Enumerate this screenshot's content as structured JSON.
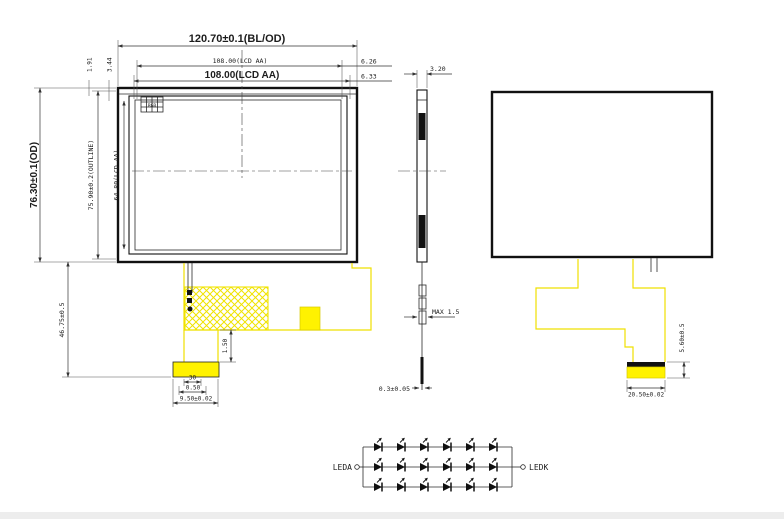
{
  "meta": {
    "title": "TFT LCD module outline drawing"
  },
  "front_view": {
    "dim_od_width": "120.70±0.1(BL/OD)",
    "dim_aa_width_small": "108.00(LCD AA)",
    "dim_aa_width": "108.00(LCD AA)",
    "dim_right_top": "6.26",
    "dim_right_bottom": "6.33",
    "dim_od_height": "76.30±0.1(OD)",
    "dim_outline_height": "75.90±0.2(OUTLINE)",
    "dim_aa_height": "64.80(LCD AA)",
    "dim_corner_a": "1.91",
    "dim_corner_b": "3.44",
    "dim_fpc_drop": "46.75±0.5",
    "dim_neck": "1.50",
    "dim_pins": "30",
    "dim_pitch": "0.50",
    "dim_tail_width": "9.50±0.02",
    "corner_detail_label": "RGB"
  },
  "side_view": {
    "dim_thickness": "3.20",
    "dim_connector_max": "MAX 1.5",
    "dim_film": "0.3±0.05"
  },
  "back_view": {
    "dim_stiffener_height": "5.60±0.5",
    "dim_stiffener_width": "20.50±0.02"
  },
  "led_circuit": {
    "anode_label": "LEDA",
    "cathode_label": "LEDK",
    "rows": 3,
    "leds_per_row": 6
  },
  "colors": {
    "fpc_yellow": "#fff200",
    "line": "#1c1c1c"
  }
}
